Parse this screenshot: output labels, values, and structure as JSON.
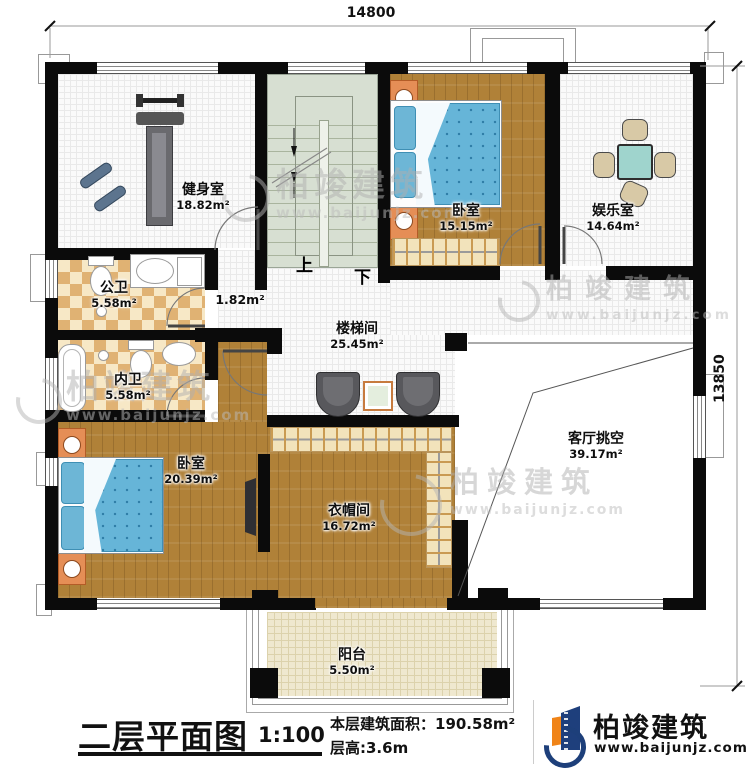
{
  "dimensions": {
    "top": "14800",
    "right": "13850"
  },
  "stairs": {
    "up": "上",
    "down": "下"
  },
  "rooms": {
    "gym": {
      "name": "健身室",
      "area": "18.82m²"
    },
    "bedroom_top": {
      "name": "卧室",
      "area": "15.15m²"
    },
    "entertainment": {
      "name": "娱乐室",
      "area": "14.64m²"
    },
    "public_bath": {
      "name": "公卫",
      "area": "5.58m²"
    },
    "stairwell": {
      "name": "楼梯间",
      "area": "25.45m²"
    },
    "lobby": {
      "area": "1.82m²"
    },
    "private_bath": {
      "name": "内卫",
      "area": "5.58m²"
    },
    "bedroom_main": {
      "name": "卧室",
      "area": "20.39m²"
    },
    "cloakroom": {
      "name": "衣帽间",
      "area": "16.72m²"
    },
    "living_void": {
      "name": "客厅挑空",
      "area": "39.17m²"
    },
    "balcony": {
      "name": "阳台",
      "area": "5.50m²"
    }
  },
  "titleblock": {
    "title": "二层平面图",
    "scale": "1:100",
    "floor_area": "本层建筑面积：190.58m²",
    "floor_height": "层高:3.6m"
  },
  "logo": {
    "name": "柏竣建筑",
    "url": "www.baijunjz.com"
  },
  "watermark": {
    "text": "柏竣建筑",
    "url": "www.baijunjz.com"
  },
  "colors": {
    "wall": "#0b0b0b",
    "wood_floor": "#b08138",
    "checker_tile": "#e0b273",
    "stair_green": "#d7dfd2",
    "mattress_blue": "#66b5d8",
    "nightstand_orange": "#e58e56",
    "logo_blue": "#1e3f7c",
    "logo_orange": "#f08418"
  }
}
